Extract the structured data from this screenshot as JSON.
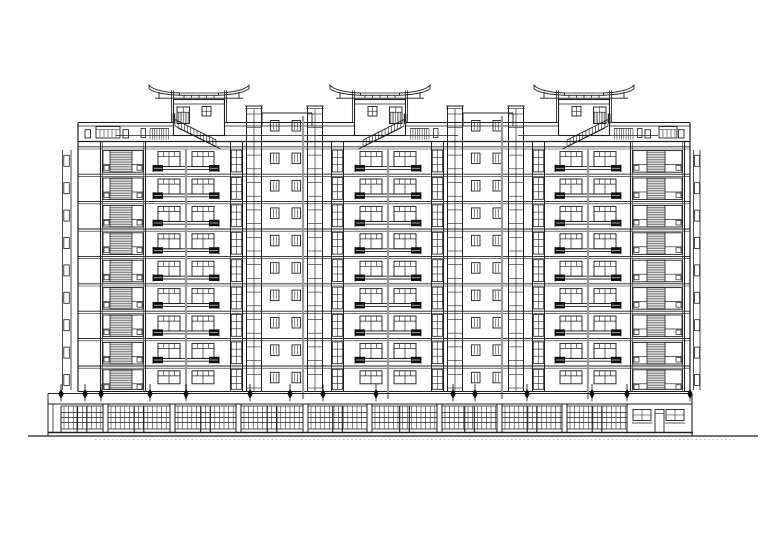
{
  "document": {
    "kind": "residential-building-front-elevation",
    "background": "#ffffff"
  },
  "palette": {
    "ink": "#1e1e1e",
    "joint": "#9a9a9a",
    "louver_line": "#6a6a6a",
    "louver_bg": "#ececec",
    "dark": "#0f0f0f",
    "white": "#ffffff",
    "stipple": "#bdbdbd"
  },
  "layout": {
    "canvas": {
      "w": 780,
      "h": 551
    },
    "ground": {
      "y": 436,
      "x1": 28,
      "x2": 758,
      "stipple_y": 439.4,
      "stipple_x1": 95,
      "stipple_x2": 735
    },
    "facade": {
      "left": 78,
      "right": 690,
      "parapet_y": 122.5,
      "coping_y": 126,
      "top_y": 141.5,
      "deck_y": 135.5,
      "first_floor_y": 146.8,
      "floor_h": 27.4,
      "floors": 9,
      "attach_y": 391.5
    },
    "edge_strips": {
      "left": {
        "v1": 62.5,
        "v2": 71,
        "tick_x": 63.8,
        "tick_w": 5.5
      },
      "right": {
        "v1": 693.5,
        "v2": 700,
        "tick_x": 694.6,
        "tick_w": 5
      }
    },
    "bayA": [
      {
        "x": 100,
        "w": 46,
        "louver_dx": 10,
        "louver_w": 22
      },
      {
        "x": 630,
        "w": 55,
        "louver_dx": 17,
        "louver_w": 18
      }
    ],
    "modules": {
      "centers": [
        186,
        388,
        588
      ],
      "win_w": 22,
      "win_off_out": 28,
      "win_off_in": 6,
      "rail_half": 33,
      "panel_w": 10
    },
    "inter": {
      "mids": [
        287,
        488
      ],
      "wall_half": 25,
      "wall_top": 113,
      "bayg": [
        {
          "dx": -57,
          "w": 13
        },
        {
          "dx": 44,
          "w": 13
        }
      ],
      "stairs": [
        {
          "dx": -41,
          "w": 16
        },
        {
          "dx": 20,
          "w": 16
        }
      ],
      "stair_top": 106,
      "stair_step": 13.7,
      "small": [
        {
          "dx": -16.5
        },
        {
          "dx": 5
        }
      ],
      "small_w": 8.5,
      "small_h": 10.5,
      "band_win_y": 120.5
    },
    "joints": {
      "module_xs": [
        186,
        388,
        588
      ],
      "inter_xs": [
        303,
        502
      ],
      "y1_module": 149,
      "y1_inter": 116,
      "y2": 399
    },
    "pagodas": {
      "centers": [
        199,
        380,
        584
      ],
      "flip": [
        false,
        true,
        true
      ],
      "wing_half": 50,
      "inner_half": 19.5,
      "tip_top": 85.3,
      "tip_bot": 88.8,
      "in_top": 93,
      "in_bot": 95.3,
      "beam_y": 98.2,
      "beam_half": 44,
      "strut_xs": [
        -15,
        -7.5,
        0,
        7.5,
        15
      ],
      "post_dx": 26.5,
      "post_top": 90.3,
      "outer_post_dx": 40,
      "outer_post_top": 92,
      "box_half": 25.5,
      "box_top": 99.5,
      "box_bot": 135.5,
      "box_inner_y": 104,
      "door": {
        "dx": -22,
        "y": 107,
        "w": 12.5,
        "h": 16.5,
        "mid_y": 112.2
      },
      "win": {
        "dx": 3,
        "y": 106.5,
        "w": 9,
        "h": 9.5
      },
      "stair": {
        "x1": -24,
        "y1": 119.5,
        "x2": 17,
        "y2": 140,
        "th": 6.5,
        "balusters": 13
      },
      "deck_rail": {
        "dx1": -49,
        "dx2": -30,
        "y": 128.5,
        "h": 11
      },
      "tick": {
        "dx": -58,
        "y": 128.5,
        "w": 4.5,
        "h": 9
      }
    },
    "roof_rails": {
      "sq_y": 129.7,
      "sq_w": 5.5,
      "sq_h": 8.3,
      "rect_y": 126.5,
      "rect_h": 11.5,
      "groups": [
        {
          "sq1": 85,
          "rect_x": 96,
          "rect_w": 24,
          "sq2": 123
        },
        {
          "sq1": 645,
          "rect_x": 659,
          "rect_w": 18,
          "sq2": 678.5
        }
      ]
    },
    "canopy": {
      "x1": 48,
      "x2": 692,
      "top": 393.5,
      "bottom": 404,
      "hangers": [
        61,
        85,
        101,
        150,
        186,
        250,
        290,
        323,
        376,
        453,
        475,
        527,
        592,
        627,
        690
      ]
    },
    "storefront": {
      "grid_top": 406,
      "grid_bottom": 429,
      "rails": [
        412.5,
        417.5,
        422.5
      ],
      "base_y": 432.5,
      "base_x1": 48,
      "base_x2": 693,
      "start": 61,
      "end": 627,
      "piers": [
        103,
        170,
        236,
        303,
        367,
        437,
        497,
        562
      ],
      "pier_w": 5,
      "mullion_step": 4.6,
      "annex": {
        "x1": 627,
        "x2": 692,
        "win_xs": [
          633,
          666
        ],
        "win_y": 409.5,
        "win_w": 18,
        "win_h": 11,
        "sill_y": 423,
        "door_x": 655,
        "door_y": 409.5,
        "door_w": 9
      }
    }
  }
}
